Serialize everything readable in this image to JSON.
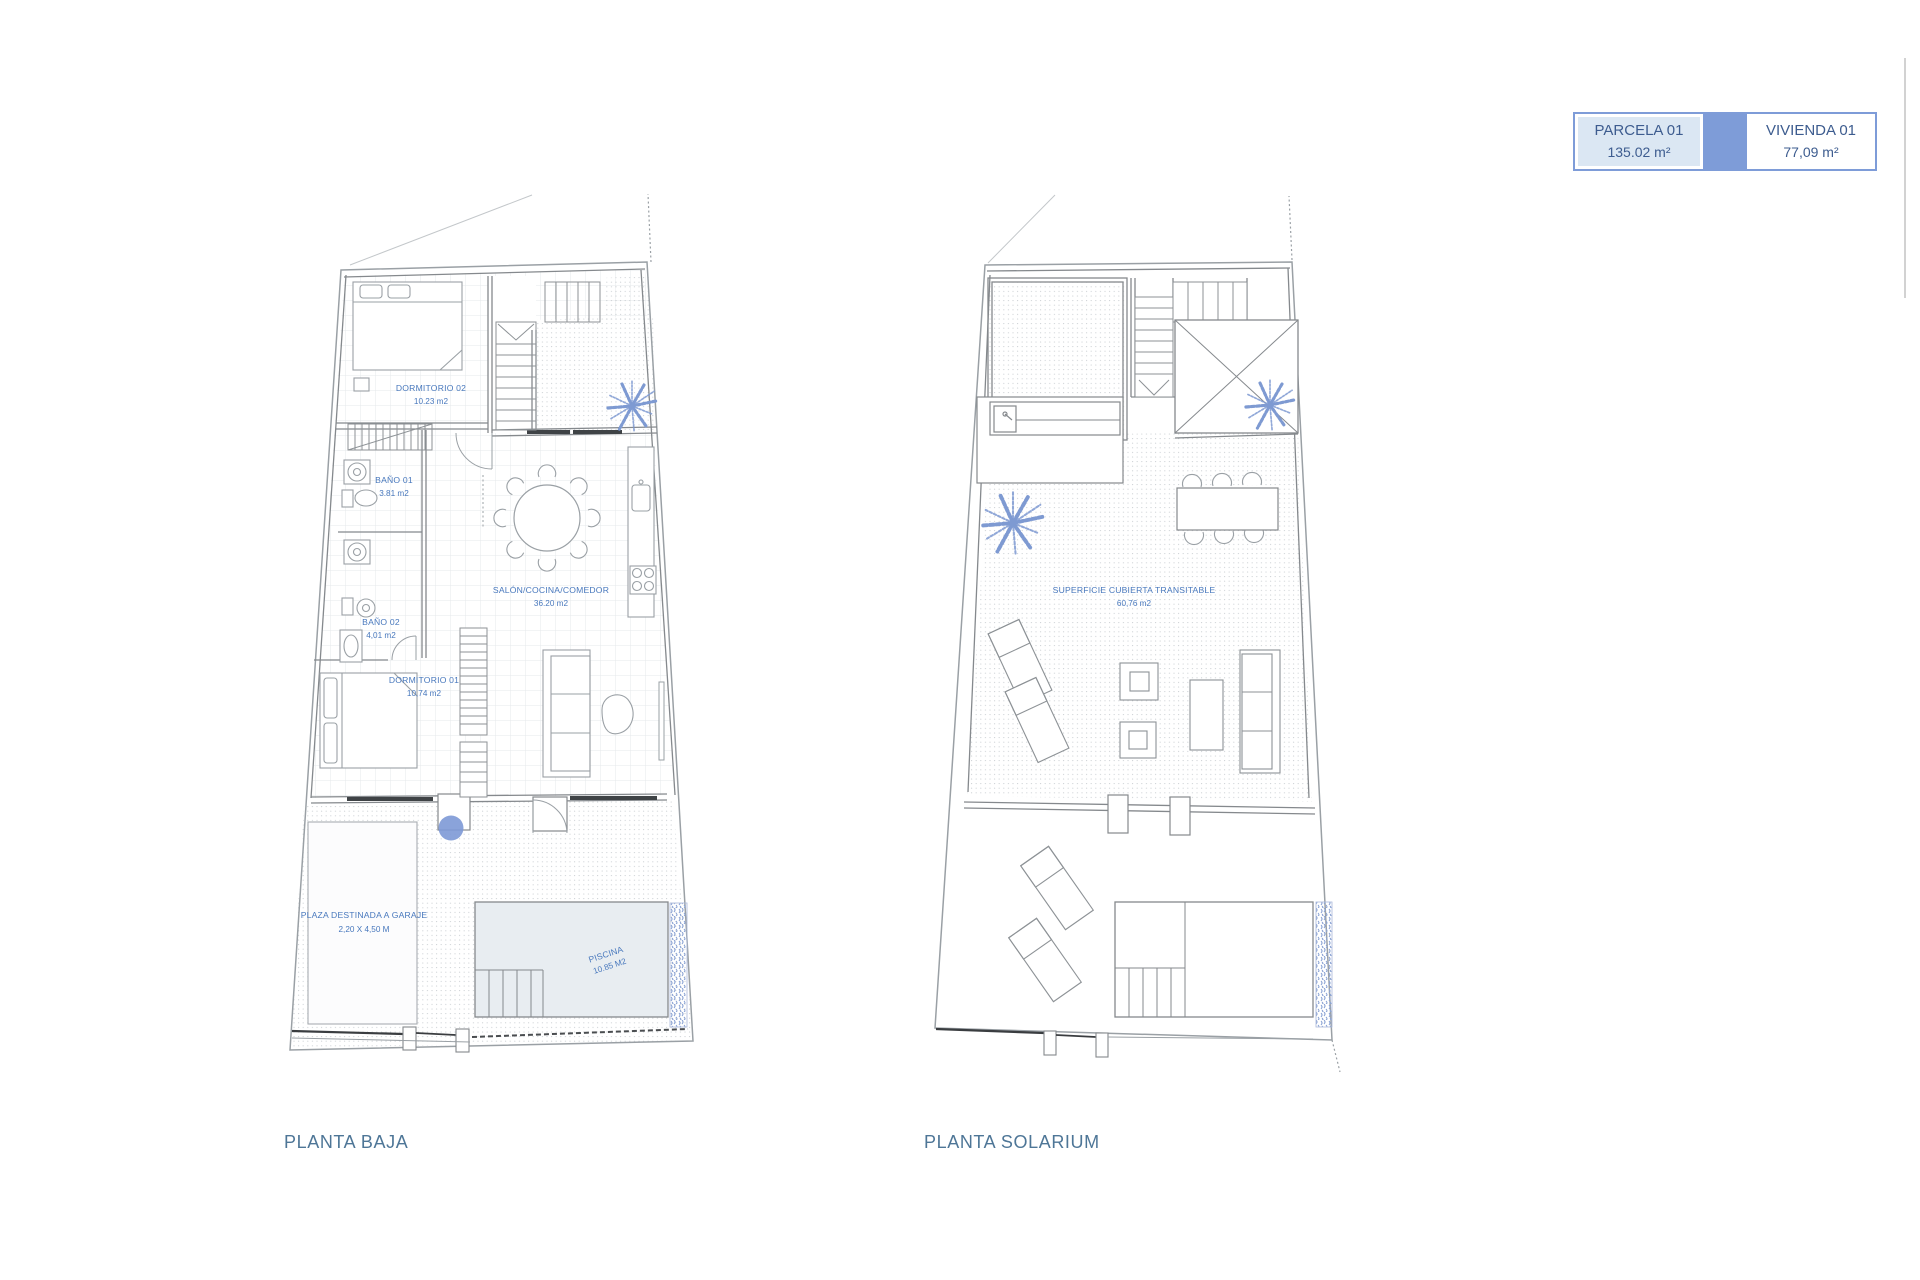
{
  "legend": {
    "parcela_title": "PARCELA 01",
    "parcela_area": "135.02 m²",
    "vivienda_title": "VIVIENDA 01",
    "vivienda_area": "77,09 m²"
  },
  "planta_baja": {
    "title": "PLANTA BAJA",
    "labels": {
      "dormitorio02": {
        "name": "DORMITORIO 02",
        "area": "10.23 m2"
      },
      "bano01": {
        "name": "BAÑO 01",
        "area": "3.81 m2"
      },
      "bano02": {
        "name": "BAÑO 02",
        "area": "4,01 m2"
      },
      "dormitorio01": {
        "name": "DORMITORIO 01",
        "area": "10,74 m2"
      },
      "salon": {
        "name": "SALÓN/COCINA/COMEDOR",
        "area": "36.20 m2"
      },
      "garaje": {
        "name": "PLAZA DESTINADA A GARAJE",
        "area": "2,20 X 4,50 M"
      },
      "piscina": {
        "name": "PISCINA",
        "area": "10.85 M2"
      }
    }
  },
  "planta_solarium": {
    "title": "PLANTA SOLARIUM",
    "labels": {
      "cubierta": {
        "name": "SUPERFICIE CUBIERTA TRANSITABLE",
        "area": "60,76 m2"
      }
    }
  },
  "colors": {
    "wall_line": "#85898d",
    "parcel_line": "#9aa0a5",
    "label_blue": "#4878bd",
    "title_blue": "#4e7697",
    "legend_border": "#7e9cd8",
    "legend_fill": "#dbe7f3",
    "legend_text": "#3d5c8f",
    "palm_blue": "#7e9ad2",
    "vegetation_blue": "#8ba3d4",
    "pool_fill": "#e8edf1",
    "fence_dark": "#3a3d40"
  }
}
